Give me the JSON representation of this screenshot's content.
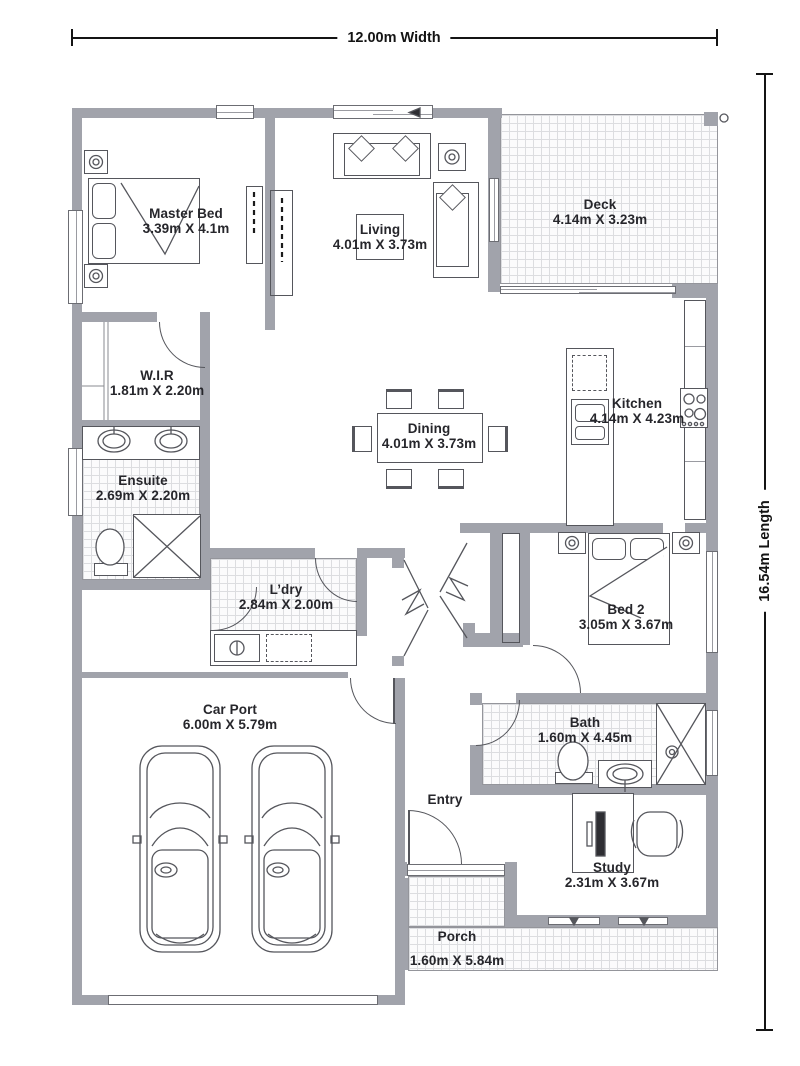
{
  "plan": {
    "width_label": "12.00m Width",
    "length_label": "16.54m Length"
  },
  "rooms": [
    {
      "name": "Master Bed",
      "dims": "3.39m X 4.1m"
    },
    {
      "name": "Living",
      "dims": "4.01m X 3.73m"
    },
    {
      "name": "Deck",
      "dims": "4.14m X 3.23m"
    },
    {
      "name": "W.I.R",
      "dims": "1.81m X 2.20m"
    },
    {
      "name": "Ensuite",
      "dims": "2.69m X 2.20m"
    },
    {
      "name": "Dining",
      "dims": "4.01m X 3.73m"
    },
    {
      "name": "Kitchen",
      "dims": "4.14m X 4.23m"
    },
    {
      "name": "L’dry",
      "dims": "2.84m X 2.00m"
    },
    {
      "name": "Bed 2",
      "dims": "3.05m X 3.67m"
    },
    {
      "name": "Car Port",
      "dims": "6.00m X 5.79m"
    },
    {
      "name": "Bath",
      "dims": "1.60m X 4.45m"
    },
    {
      "name": "Entry",
      "dims": ""
    },
    {
      "name": "Study",
      "dims": "2.31m X 3.67m"
    },
    {
      "name": "Porch",
      "dims": "1.60m X 5.84m"
    }
  ],
  "colors": {
    "wall": "#a1a3ab",
    "line": "#55565c",
    "text": "#26262b",
    "dimension": "#141414"
  }
}
